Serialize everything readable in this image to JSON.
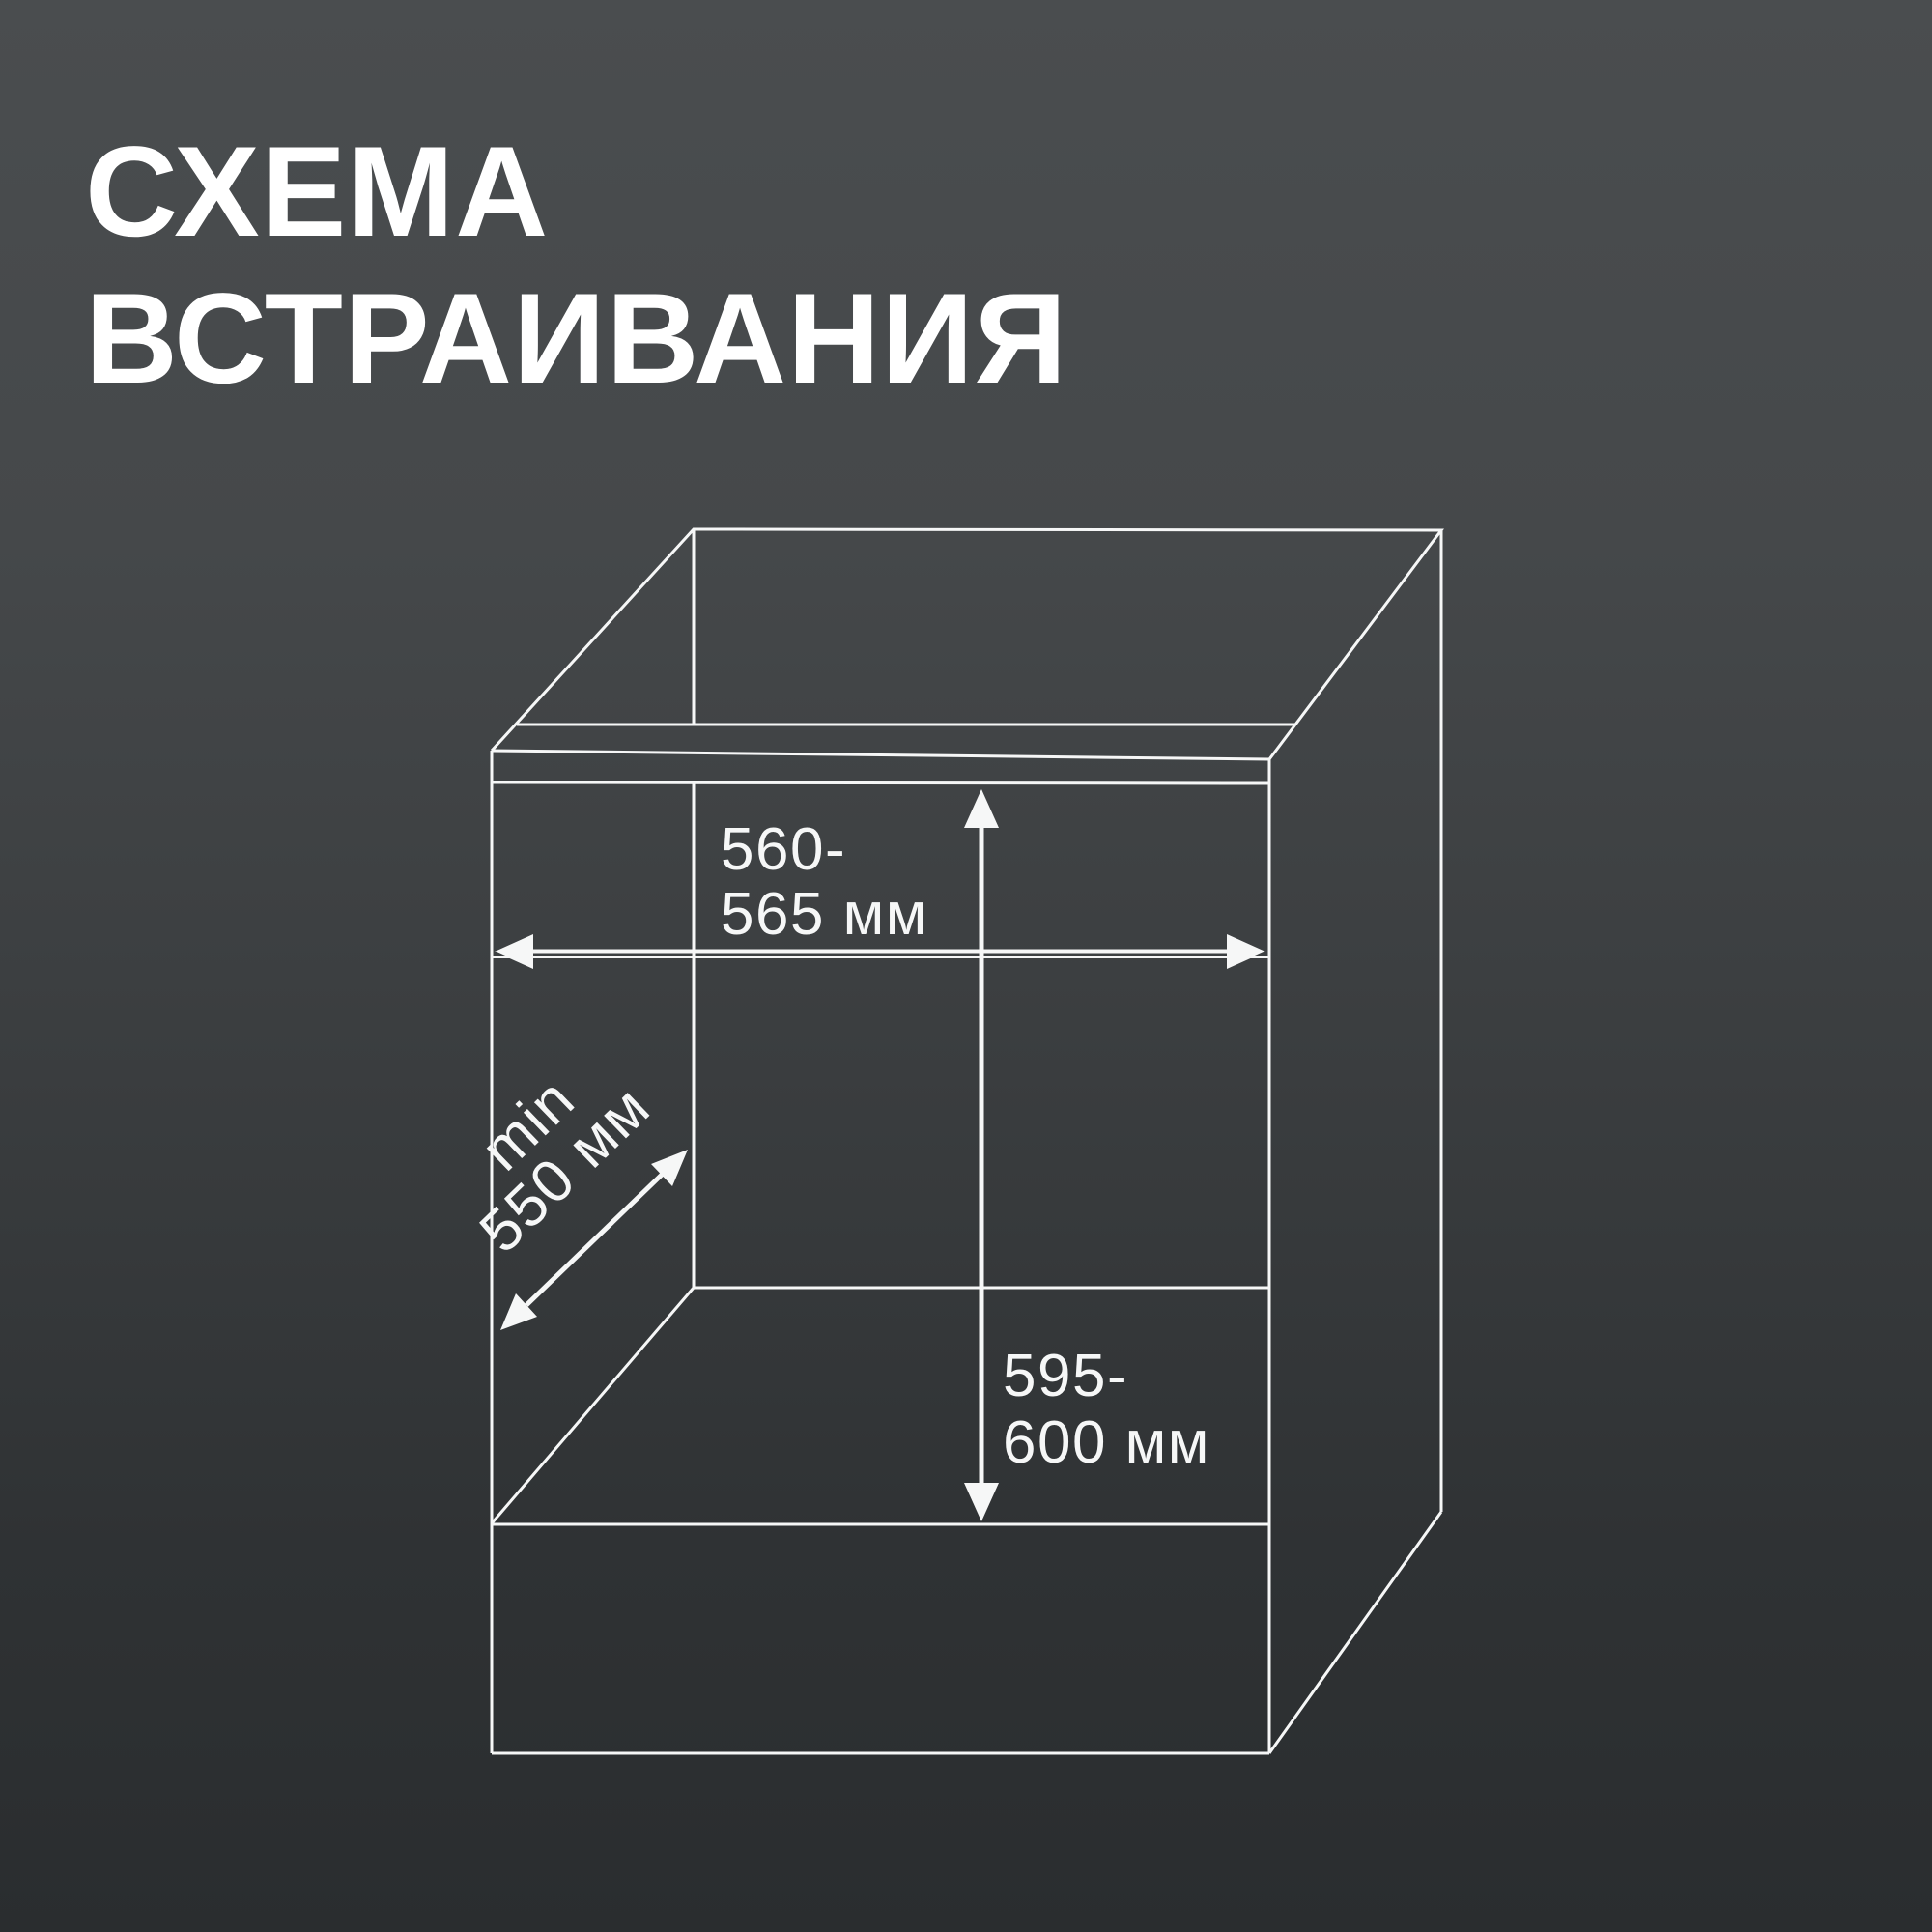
{
  "title": {
    "line1": "СХЕМА",
    "line2": "ВСТРАИВАНИЯ"
  },
  "diagram": {
    "labels": {
      "width": {
        "line1": "560-",
        "line2": "565 мм"
      },
      "depth": {
        "line1": "min",
        "line2": "550 мм"
      },
      "height": {
        "line1": "595-",
        "line2": "600 мм"
      }
    }
  },
  "colors": {
    "background_top": "#4a4d4f",
    "background_bottom": "#2a2d2f",
    "line": "#f6f7f7",
    "text": "#f6f7f7"
  }
}
